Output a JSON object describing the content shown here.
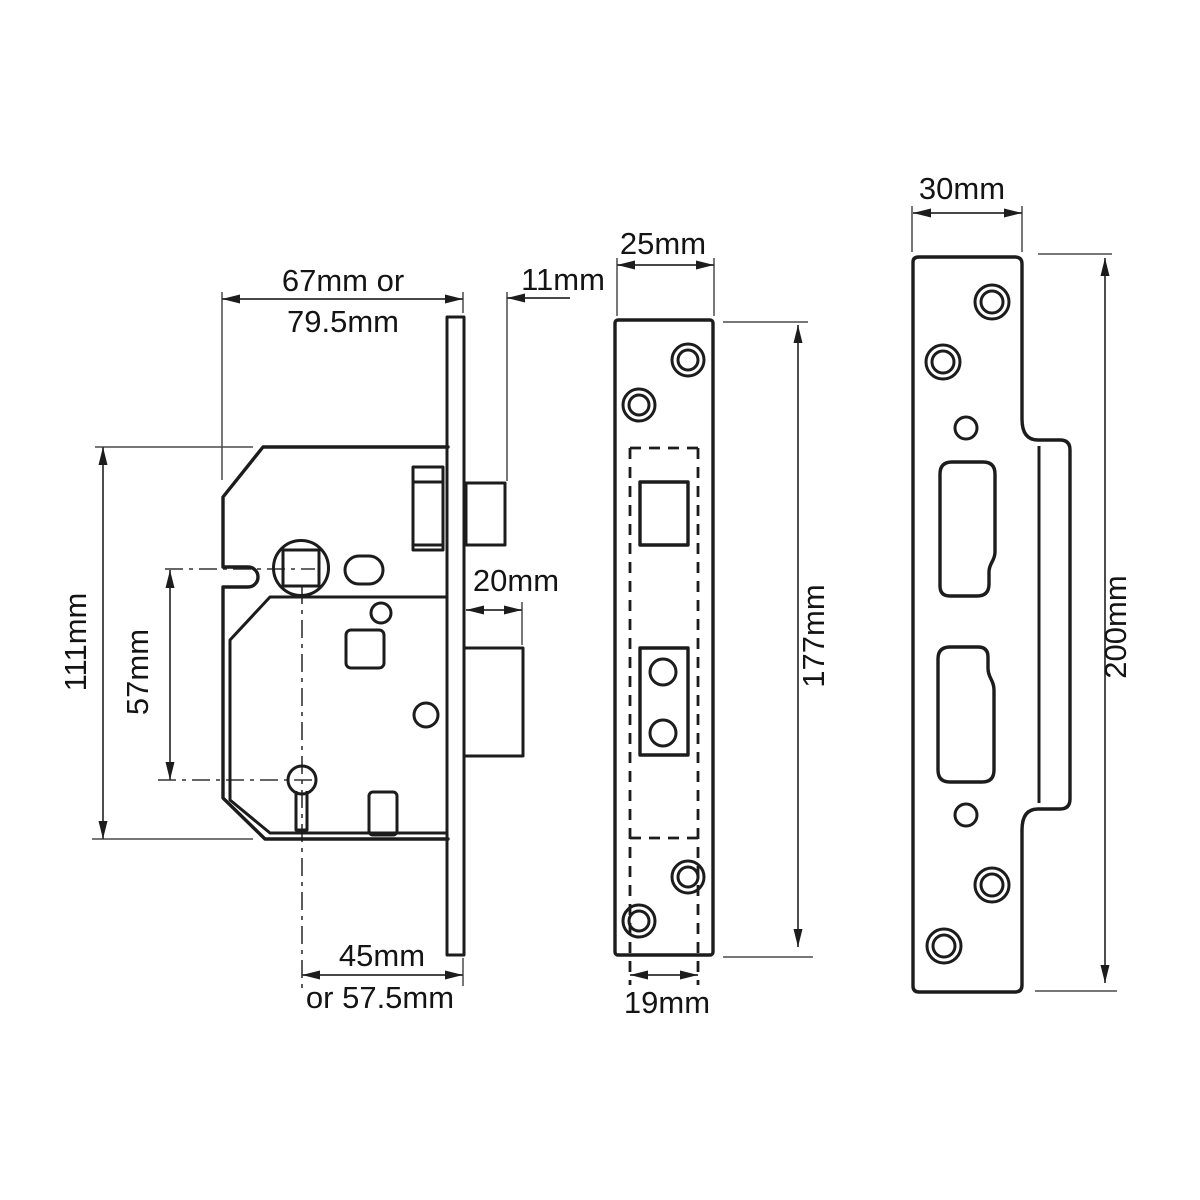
{
  "diagram": {
    "views": {
      "lock_body": {
        "case_width": "67mm or",
        "case_width_alt": "79.5mm",
        "latch_projection": "11mm",
        "case_height": "111mm",
        "spindle_to_key": "57mm",
        "bolt_throw": "20mm",
        "backset": "45mm",
        "backset_alt": "or 57.5mm"
      },
      "faceplate": {
        "width": "25mm",
        "height": "177mm",
        "inner_width": "19mm"
      },
      "strike_plate": {
        "width": "30mm",
        "height": "200mm"
      }
    },
    "colors": {
      "line": "#1c1c1c",
      "dimension": "#2e2e2e",
      "background": "#ffffff"
    }
  }
}
